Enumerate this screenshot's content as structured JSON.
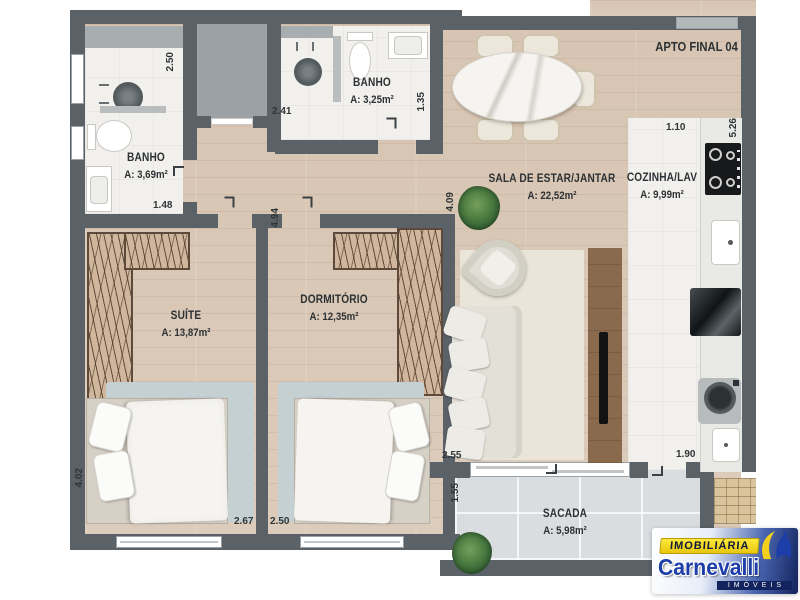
{
  "plan": {
    "apt_label": "APTO FINAL 04",
    "rooms": {
      "banho1": {
        "name": "BANHO",
        "area": "A: 3,69m²"
      },
      "banho2": {
        "name": "BANHO",
        "area": "A: 3,25m²"
      },
      "sala": {
        "name": "SALA DE ESTAR/JANTAR",
        "area": "A: 22,52m²"
      },
      "cozinha": {
        "name": "COZINHA/LAV",
        "area": "A: 9,99m²"
      },
      "suite": {
        "name": "SUÍTE",
        "area": "A: 13,87m²"
      },
      "dormitorio": {
        "name": "DORMITÓRIO",
        "area": "A: 12,35m²"
      },
      "sacada": {
        "name": "SACADA",
        "area": "A: 5,98m²"
      }
    },
    "dimensions": {
      "banho1_height": "2.50",
      "banho1_width": "1.48",
      "banho2_width": "2.41",
      "banho2_height": "1.35",
      "hall_height": "4.94",
      "sala_height": "4.09",
      "cozinha_width": "1.10",
      "cozinha_height": "5.26",
      "suite_height": "4.02",
      "suite_width": "2.67",
      "dormitorio_width": "2.50",
      "sala_width": "2.55",
      "sacada_height": "1.55",
      "lav_width": "1.90"
    }
  },
  "logo": {
    "banner": "IMOBILIÁRIA",
    "name": "Carnevalli",
    "tagline": "IMÓVEIS",
    "colors": {
      "blue": "#1d3da8",
      "dark_blue": "#13235d",
      "yellow": "#f2d21f"
    }
  },
  "colors": {
    "wall": "#5a6268",
    "wood_floor": "#d9c8b7",
    "white_floor": "#f1f0ec",
    "balcony_tile": "#d9dddf",
    "shaft_gray": "#9ba1a5",
    "wardrobe_tan": "#cfb69c",
    "rug_blue": "#c4d0d2"
  }
}
